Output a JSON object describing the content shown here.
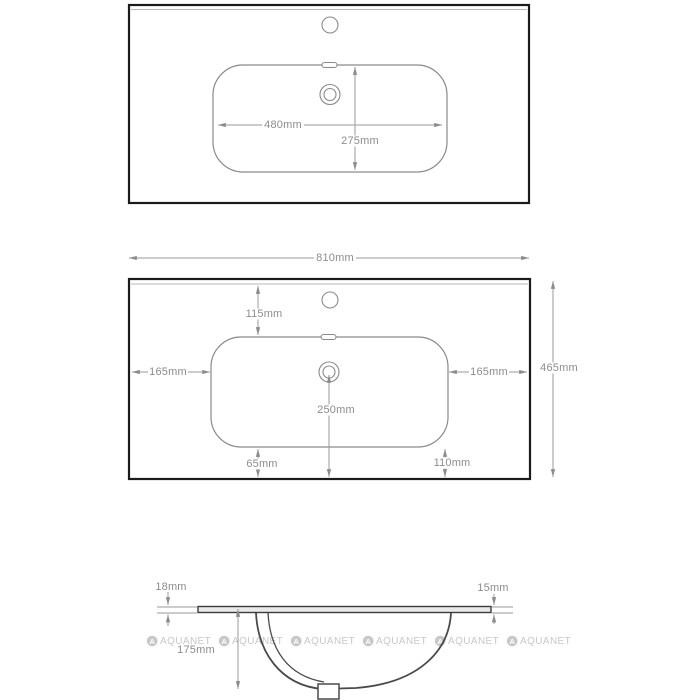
{
  "page": {
    "background": "#ffffff"
  },
  "top_view": {
    "basin_width_label": "480mm",
    "basin_depth_label": "275mm"
  },
  "mid_view": {
    "total_width_label": "810mm",
    "total_depth_label": "465mm",
    "faucet_offset_label": "115mm",
    "left_margin_label": "165mm",
    "right_margin_label": "165mm",
    "drain_offset_label": "250mm",
    "bottom_left_label": "65mm",
    "bottom_right_label": "110mm"
  },
  "side_view": {
    "left_thickness_label": "18mm",
    "right_thickness_label": "15mm",
    "bowl_depth_label": "175mm"
  },
  "watermark": {
    "logo_letter": "A",
    "text": "AQUANET",
    "color": "#c8c8c8"
  },
  "colors": {
    "outline": "#1b1b1b",
    "drawing_line": "#8a8a8a",
    "dimension": "#8c8c8c",
    "watermark": "#c8c8c8"
  }
}
